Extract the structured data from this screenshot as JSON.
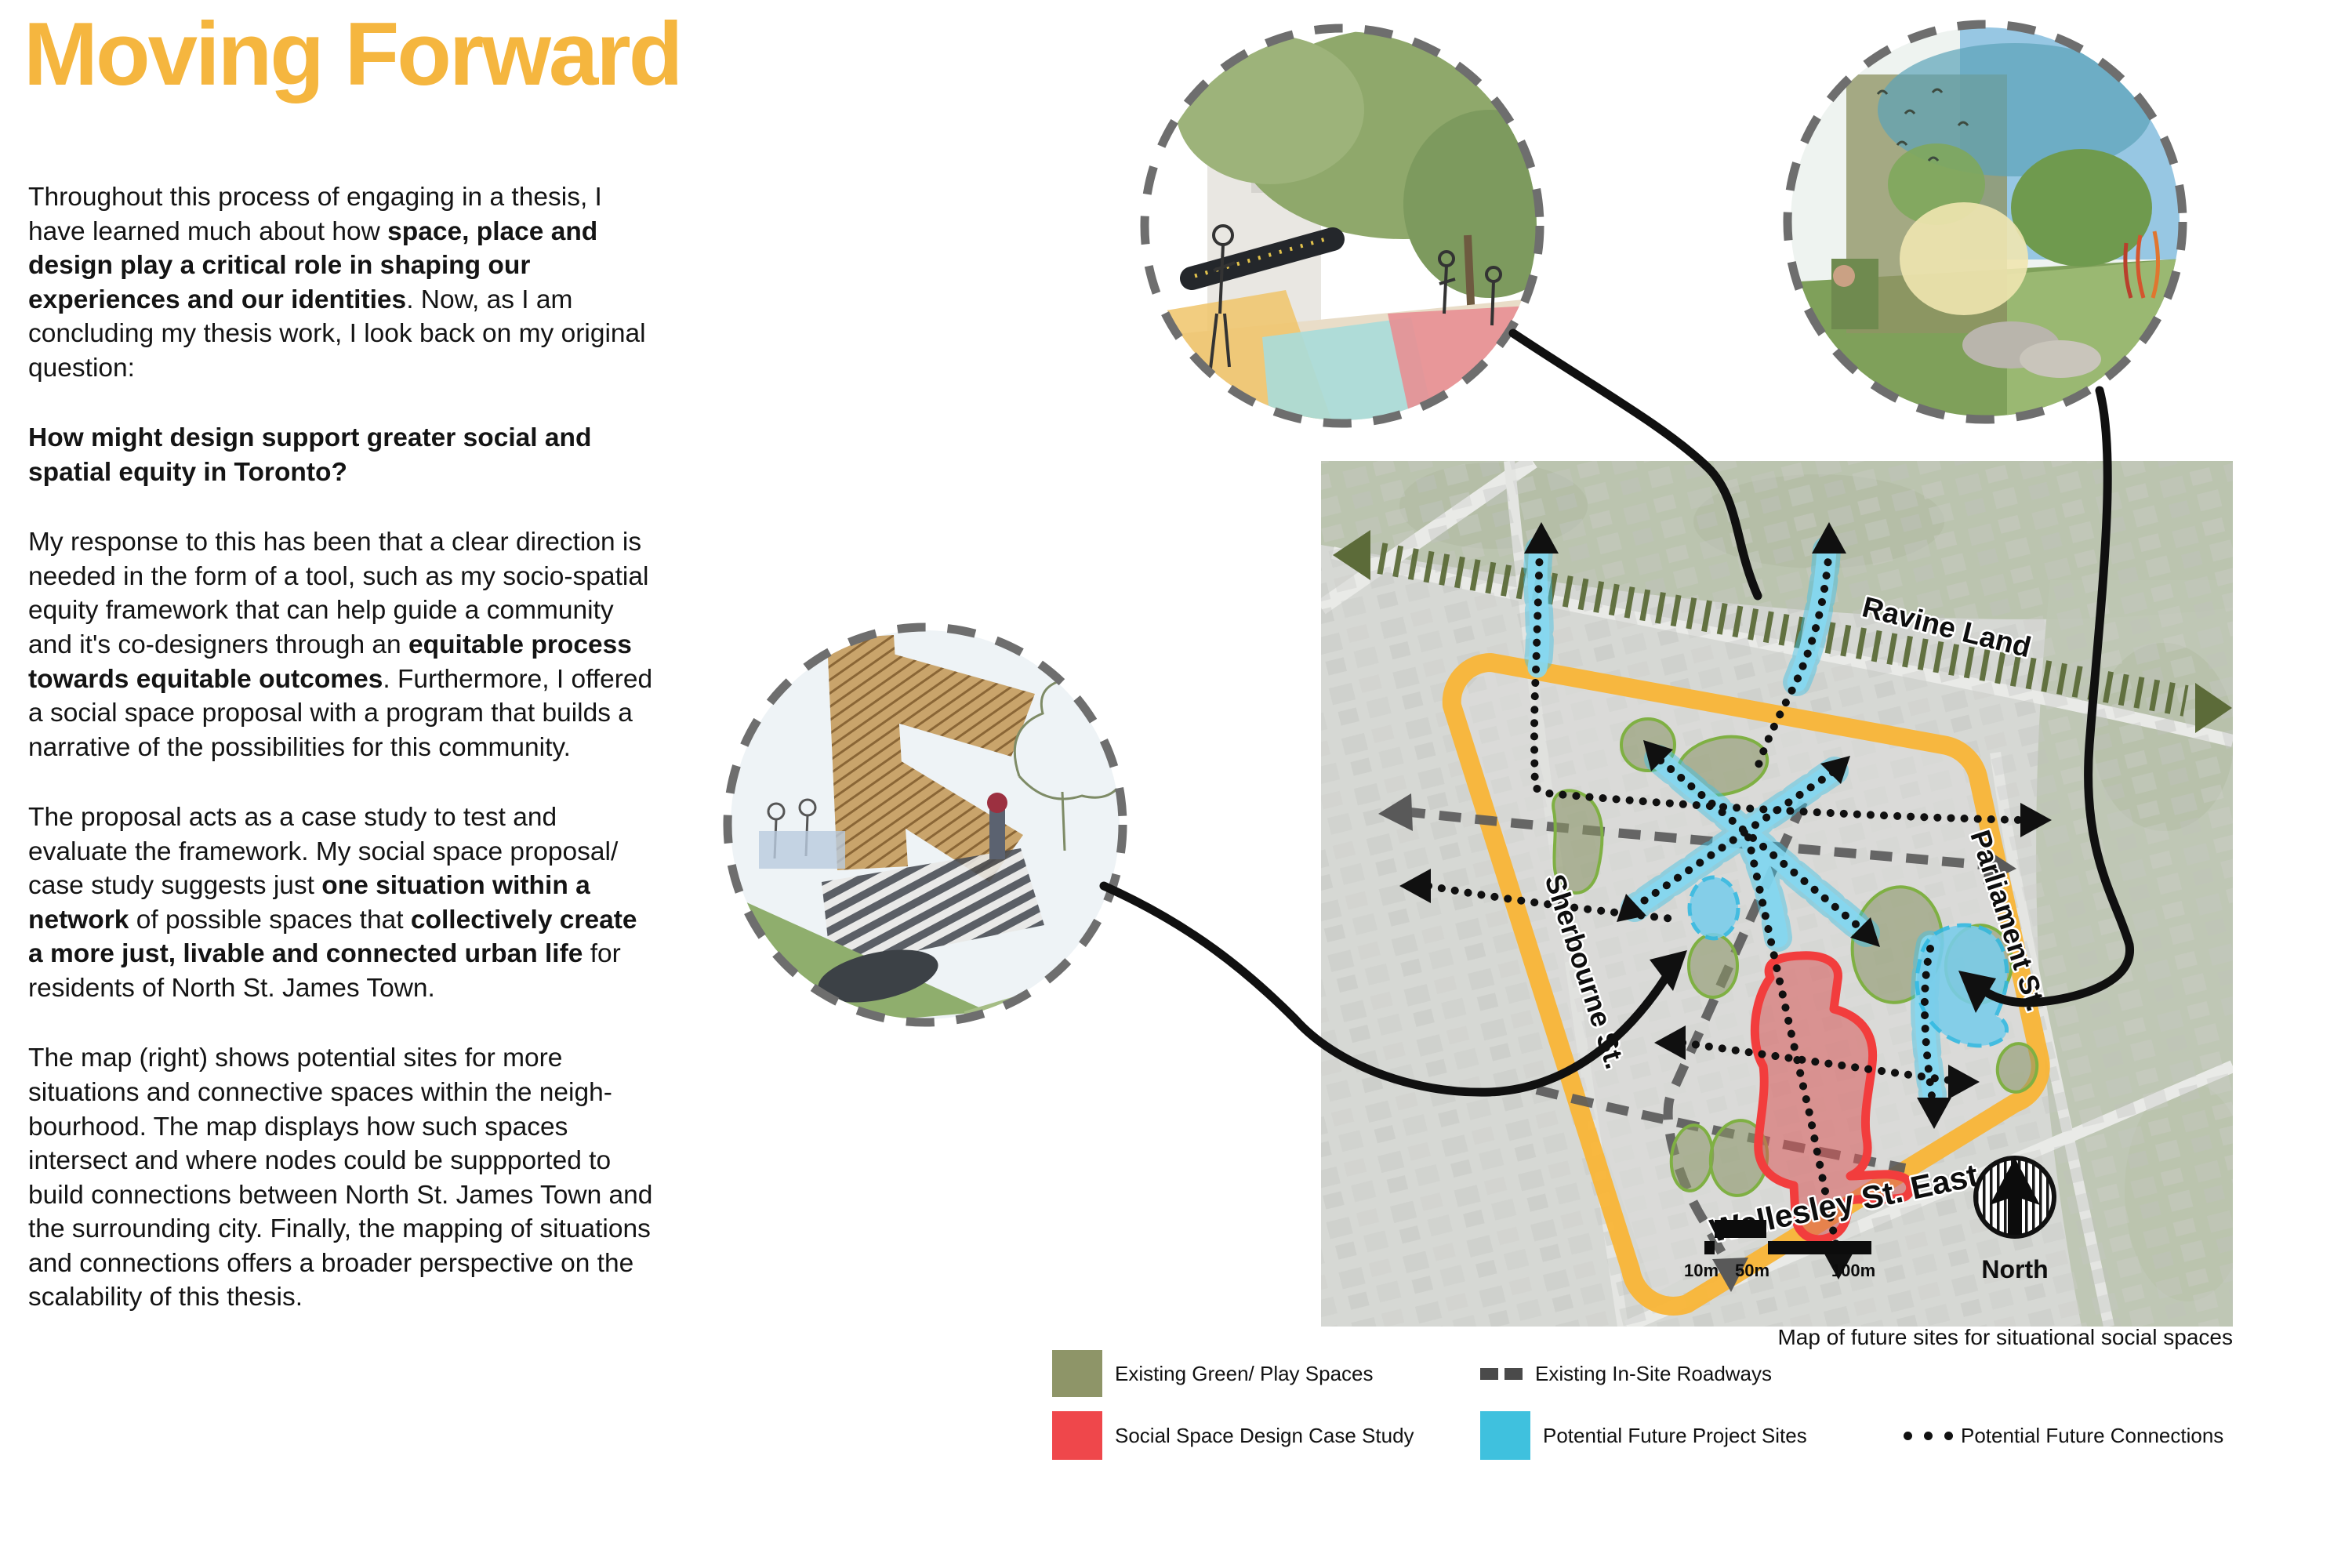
{
  "page": {
    "title": "Moving Forward"
  },
  "intro": {
    "paragraphs": [
      {
        "question": false,
        "segments": [
          {
            "text": "Throughout this process of engaging in a thesis, I have learned much about how ",
            "bold": false
          },
          {
            "text": "space, place and design play a critical role in shaping our experiences and our identities",
            "bold": true
          },
          {
            "text": ". Now, as I am concluding my thesis work, I look back on my original question:",
            "bold": false
          }
        ]
      },
      {
        "question": true,
        "segments": [
          {
            "text": "How might design support greater social and spatial equity in Toronto?",
            "bold": true
          }
        ]
      },
      {
        "question": false,
        "segments": [
          {
            "text": "My response to this has been that a clear direction is needed in the form of a tool, such as my socio-spatial equity framework that can help guide a community and it's co-designers through an ",
            "bold": false
          },
          {
            "text": "equitable process towards equitable outcomes",
            "bold": true
          },
          {
            "text": ". Furthermore, I offered a social space proposal with a program that builds a narrative of the possibilities for this community.",
            "bold": false
          }
        ]
      },
      {
        "question": false,
        "segments": [
          {
            "text": "The proposal acts as a case study to test and evaluate the framework. My social space proposal/ case study suggests just ",
            "bold": false
          },
          {
            "text": "one situation within a network",
            "bold": true
          },
          {
            "text": " of possible spaces that ",
            "bold": false
          },
          {
            "text": "collectively create a more just, livable and connected urban life",
            "bold": true
          },
          {
            "text": " for residents of North St. James Town.",
            "bold": false
          }
        ]
      },
      {
        "question": false,
        "segments": [
          {
            "text": "The map (right) shows potential sites for more situations and connective spaces within the neigh-bourhood. The map displays how such spaces intersect and where nodes could be suppported to build connections between North St. James Town and the surrounding city. Finally, the mapping of situations and connections offers a broader perspective on the scalability of this thesis.",
            "bold": false
          }
        ]
      }
    ]
  },
  "map": {
    "streets": {
      "bloor": "Bloor St. East",
      "ravine": "Ravine Land",
      "parliament": "Parliament St.",
      "sherbourne": "Sherbourne St.",
      "wellesley": "Wellesley St. East"
    },
    "north_label": "North",
    "scale": {
      "s10": "10m",
      "s50": "50m",
      "s100": "100m"
    },
    "caption": "Map of future sites for situational social spaces"
  },
  "legend": {
    "items": [
      {
        "id": "green",
        "label": "Existing Green/ Play Spaces",
        "color": "#8E9568",
        "type": "swatch"
      },
      {
        "id": "roadways",
        "label": "Existing In-Site Roadways",
        "color": "#4a4a4a",
        "type": "dashes"
      },
      {
        "id": "red",
        "label": "Social Space Design Case Study",
        "color": "#EF474B",
        "type": "swatch"
      },
      {
        "id": "cyan",
        "label": "Potential Future Project Sites",
        "color": "#3FC1DE",
        "type": "swatch"
      },
      {
        "id": "connections",
        "label": "Potential Future Connections",
        "color": "#111111",
        "type": "dots"
      }
    ]
  },
  "colors": {
    "title_accent": "#F5B63F",
    "site_boundary_yellow": "#F9B537",
    "ravine_olive": "#5C6B39",
    "future_site_cyan": "#56C6E4",
    "case_study_red": "#EF4444",
    "green_space": "#8E9568"
  }
}
